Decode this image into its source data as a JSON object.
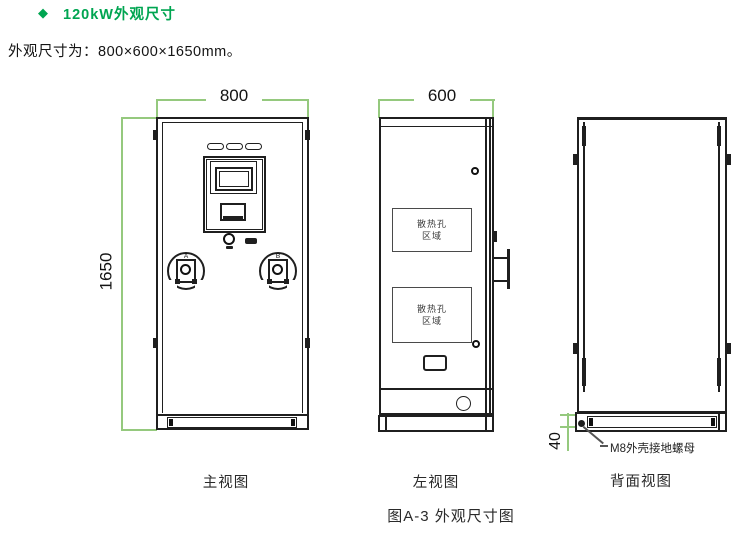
{
  "header": {
    "bullet": "◆",
    "title": "120kW外观尺寸",
    "subtitle": "外观尺寸为：800×600×1650mm。"
  },
  "figure": {
    "caption": "图A-3 外观尺寸图"
  },
  "colors": {
    "accent_green": "#00a551",
    "dimension_green": "#95c97e",
    "line": "#1f1f1f"
  },
  "front_view": {
    "caption": "主视图",
    "width_dim": "800",
    "height_dim": "1650",
    "gun_labels": [
      "A",
      "B"
    ]
  },
  "left_view": {
    "caption": "左视图",
    "width_dim": "600",
    "vent_label": [
      "散热孔",
      "区域"
    ]
  },
  "back_view": {
    "caption": "背面视图",
    "base_dim": "40",
    "ground_label": "M8外壳接地螺母"
  }
}
